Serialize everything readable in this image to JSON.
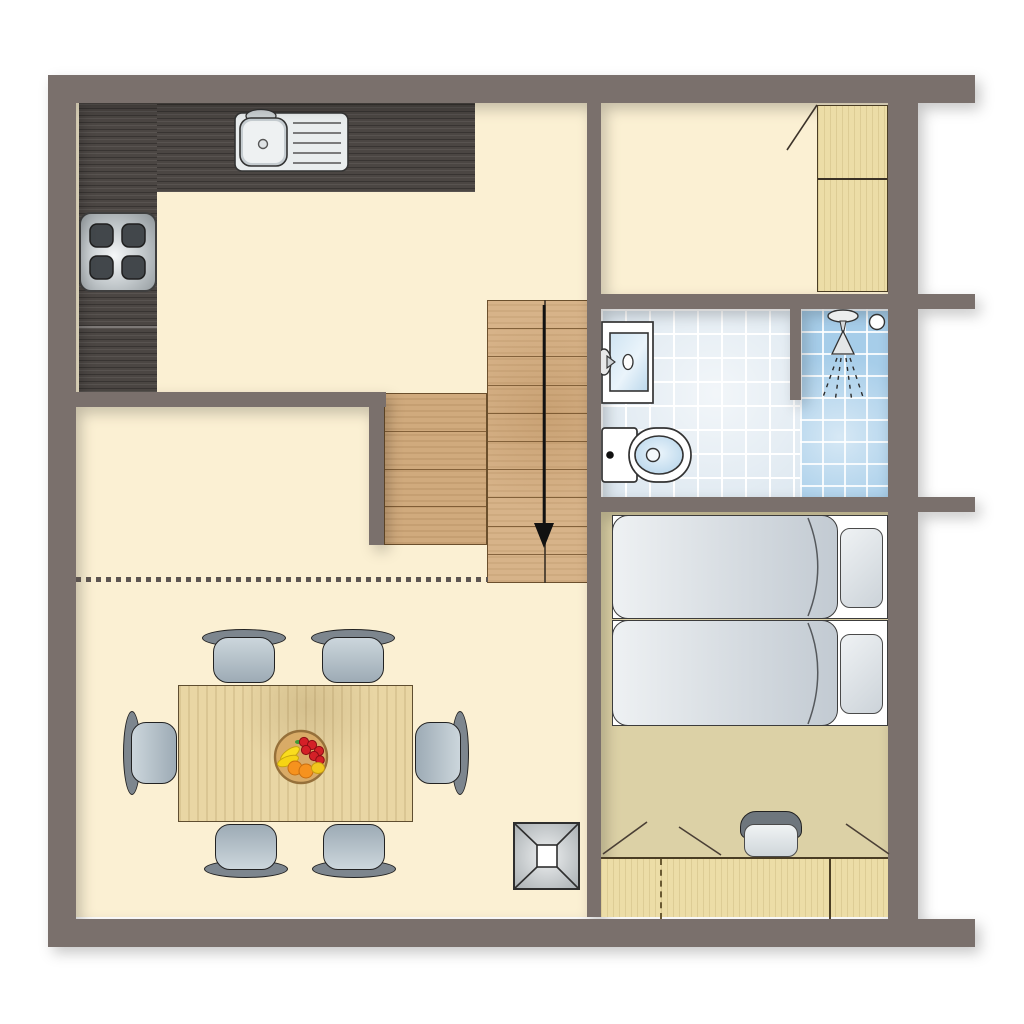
{
  "title": "holiday-home upper floor plan",
  "palette": {
    "wall": "#7a706c",
    "cream": "#fbf0d3",
    "tan": "#dcd1a6",
    "counter": "#4b4643",
    "stair": "#d7b389",
    "stairside": "#d0aa7d",
    "stairline": "#6b4f2c",
    "woodlight": "#ecdda7",
    "tablewood": "#e9d6a4",
    "tile": "#dfe9f1",
    "shower": "#a6cde9",
    "grout": "#ffffff",
    "chairback": "#7d868e",
    "dot": "#5c5450",
    "arrow": "#111111"
  },
  "stairs": {
    "main_flight_steps": 10,
    "side_flight_steps": 4,
    "direction_arrow": "down"
  },
  "inventory": {
    "dining_chairs": 6,
    "beds": 2,
    "pillows": 2,
    "stove_burners": 4,
    "sink_drainboard_lines": 5,
    "wardrobe_sections": 2,
    "desk_sections": 3,
    "skylights": 1,
    "fruit_bowls": 1
  }
}
